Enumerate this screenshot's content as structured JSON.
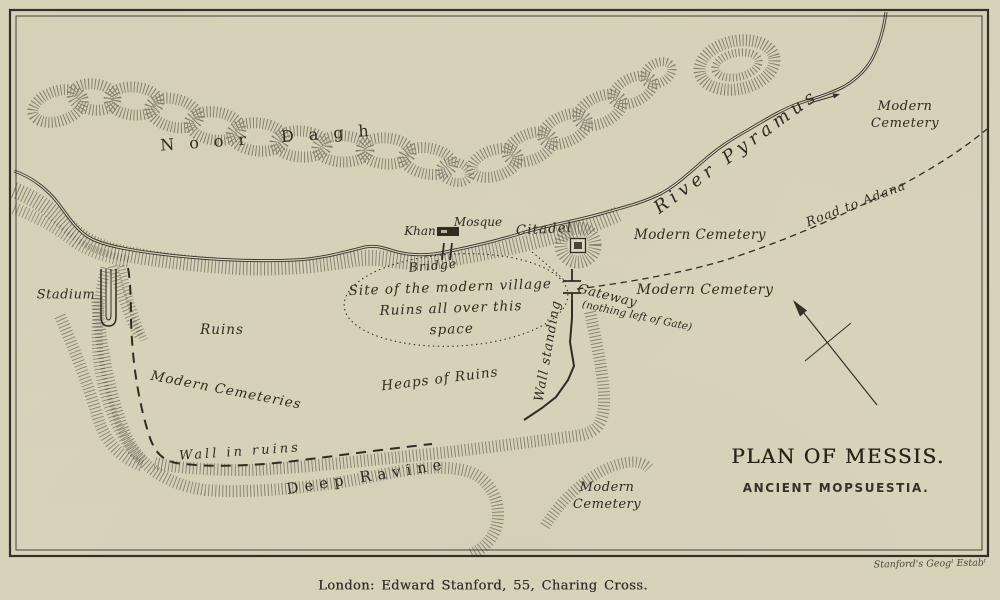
{
  "map": {
    "title_block": {
      "title": "PLAN OF MESSIS.",
      "subtitle": "ANCIENT MOPSUESTIA."
    },
    "imprint": "London: Edward Stanford, 55, Charing Cross.",
    "engraver_credit": "Stanford's Geogˡ Estabᵗ",
    "colors": {
      "paper": "#d6d3b9",
      "paper_inner": "#d9d6bc",
      "ink": "#32302a",
      "hachure": "#3a382f"
    },
    "features": [
      "noor-dagh-range",
      "river-pyramus",
      "river-bluff-hachure",
      "bridge",
      "khan-building",
      "citadel-fort",
      "gateway",
      "wall-standing-line",
      "wall-in-ruins-dashed",
      "road-to-adana-dashed",
      "village-site-ellipse",
      "stadium-outline",
      "deep-ravine-hachure",
      "north-arrow",
      "map-frame",
      "flow-direction-arrow"
    ],
    "labels": [
      {
        "name": "label-noor-dagh",
        "text": "Noor Dagh",
        "x": 272,
        "y": 138,
        "rot": -4,
        "size": 16,
        "spacing": 15,
        "style": "roman"
      },
      {
        "name": "label-river-pyramus",
        "text": "River Pyramus",
        "x": 737,
        "y": 152,
        "rot": -36,
        "size": 18,
        "spacing": 5,
        "style": "italic"
      },
      {
        "name": "label-modern-cemetery-ne",
        "lines": [
          "Modern",
          "Cemetery"
        ],
        "x": 905,
        "y": 115,
        "rot": 0,
        "size": 13,
        "spacing": 0.5,
        "style": "italic",
        "lh": 17
      },
      {
        "name": "label-road-to-adana",
        "text": "Road to Adana",
        "x": 856,
        "y": 204,
        "rot": -21,
        "size": 12.5,
        "spacing": 1,
        "style": "italic"
      },
      {
        "name": "label-khan",
        "text": "Khan",
        "x": 420,
        "y": 232,
        "rot": 0,
        "size": 12,
        "spacing": 0,
        "style": "italic"
      },
      {
        "name": "label-mosque",
        "text": "Mosque",
        "x": 478,
        "y": 223,
        "rot": 0,
        "size": 12,
        "spacing": 0,
        "style": "italic"
      },
      {
        "name": "label-bridge",
        "text": "Bridge",
        "x": 433,
        "y": 266,
        "rot": -5,
        "size": 12.5,
        "spacing": 1,
        "style": "italic"
      },
      {
        "name": "label-citadel",
        "text": "Citadel",
        "x": 544,
        "y": 230,
        "rot": -3,
        "size": 13.5,
        "spacing": 1,
        "style": "italic"
      },
      {
        "name": "label-modern-cemetery-1",
        "text": "Modern Cemetery",
        "x": 700,
        "y": 236,
        "rot": 0,
        "size": 13.5,
        "spacing": 0.5,
        "style": "italic"
      },
      {
        "name": "label-modern-cemetery-2",
        "text": "Modern Cemetery",
        "x": 705,
        "y": 290,
        "rot": 0,
        "size": 14,
        "spacing": 0.5,
        "style": "italic"
      },
      {
        "name": "label-gateway",
        "text": "Gateway",
        "x": 607,
        "y": 297,
        "rot": 14,
        "size": 13,
        "spacing": 0.5,
        "style": "italic"
      },
      {
        "name": "label-gateway-note",
        "text": "(nothing left of Gate)",
        "x": 637,
        "y": 316,
        "rot": 12,
        "size": 10.5,
        "spacing": 0,
        "style": "italic"
      },
      {
        "name": "label-wall-standing",
        "text": "Wall standing",
        "x": 549,
        "y": 351,
        "rot": -80,
        "size": 13,
        "spacing": 1,
        "style": "italic"
      },
      {
        "name": "label-village-site",
        "lines": [
          "Site of the modern village",
          "Ruins all over this",
          "space"
        ],
        "x": 451,
        "y": 309,
        "rot": -2,
        "size": 13.5,
        "spacing": 1,
        "style": "italic",
        "lh": 21
      },
      {
        "name": "label-stadium",
        "text": "Stadium",
        "x": 66,
        "y": 296,
        "rot": 0,
        "size": 13,
        "spacing": 0.5,
        "style": "italic"
      },
      {
        "name": "label-ruins",
        "text": "Ruins",
        "x": 222,
        "y": 331,
        "rot": 0,
        "size": 13.5,
        "spacing": 1,
        "style": "italic"
      },
      {
        "name": "label-modern-cemeteries",
        "text": "Modern Cemeteries",
        "x": 226,
        "y": 391,
        "rot": 11,
        "size": 13.5,
        "spacing": 1,
        "style": "italic"
      },
      {
        "name": "label-heaps-of-ruins",
        "text": "Heaps of Ruins",
        "x": 440,
        "y": 380,
        "rot": -7,
        "size": 13.5,
        "spacing": 1,
        "style": "italic"
      },
      {
        "name": "label-wall-in-ruins",
        "text": "Wall in ruins",
        "x": 240,
        "y": 453,
        "rot": -4,
        "size": 13,
        "spacing": 3,
        "style": "italic"
      },
      {
        "name": "label-deep-ravine",
        "text": "Deep Ravine",
        "x": 367,
        "y": 477,
        "rot": -9,
        "size": 15,
        "spacing": 6,
        "style": "roman"
      },
      {
        "name": "label-modern-cemetery-s",
        "lines": [
          "Modern",
          "Cemetery"
        ],
        "x": 607,
        "y": 496,
        "rot": 0,
        "size": 13,
        "spacing": 0.5,
        "style": "italic",
        "lh": 17
      }
    ]
  }
}
